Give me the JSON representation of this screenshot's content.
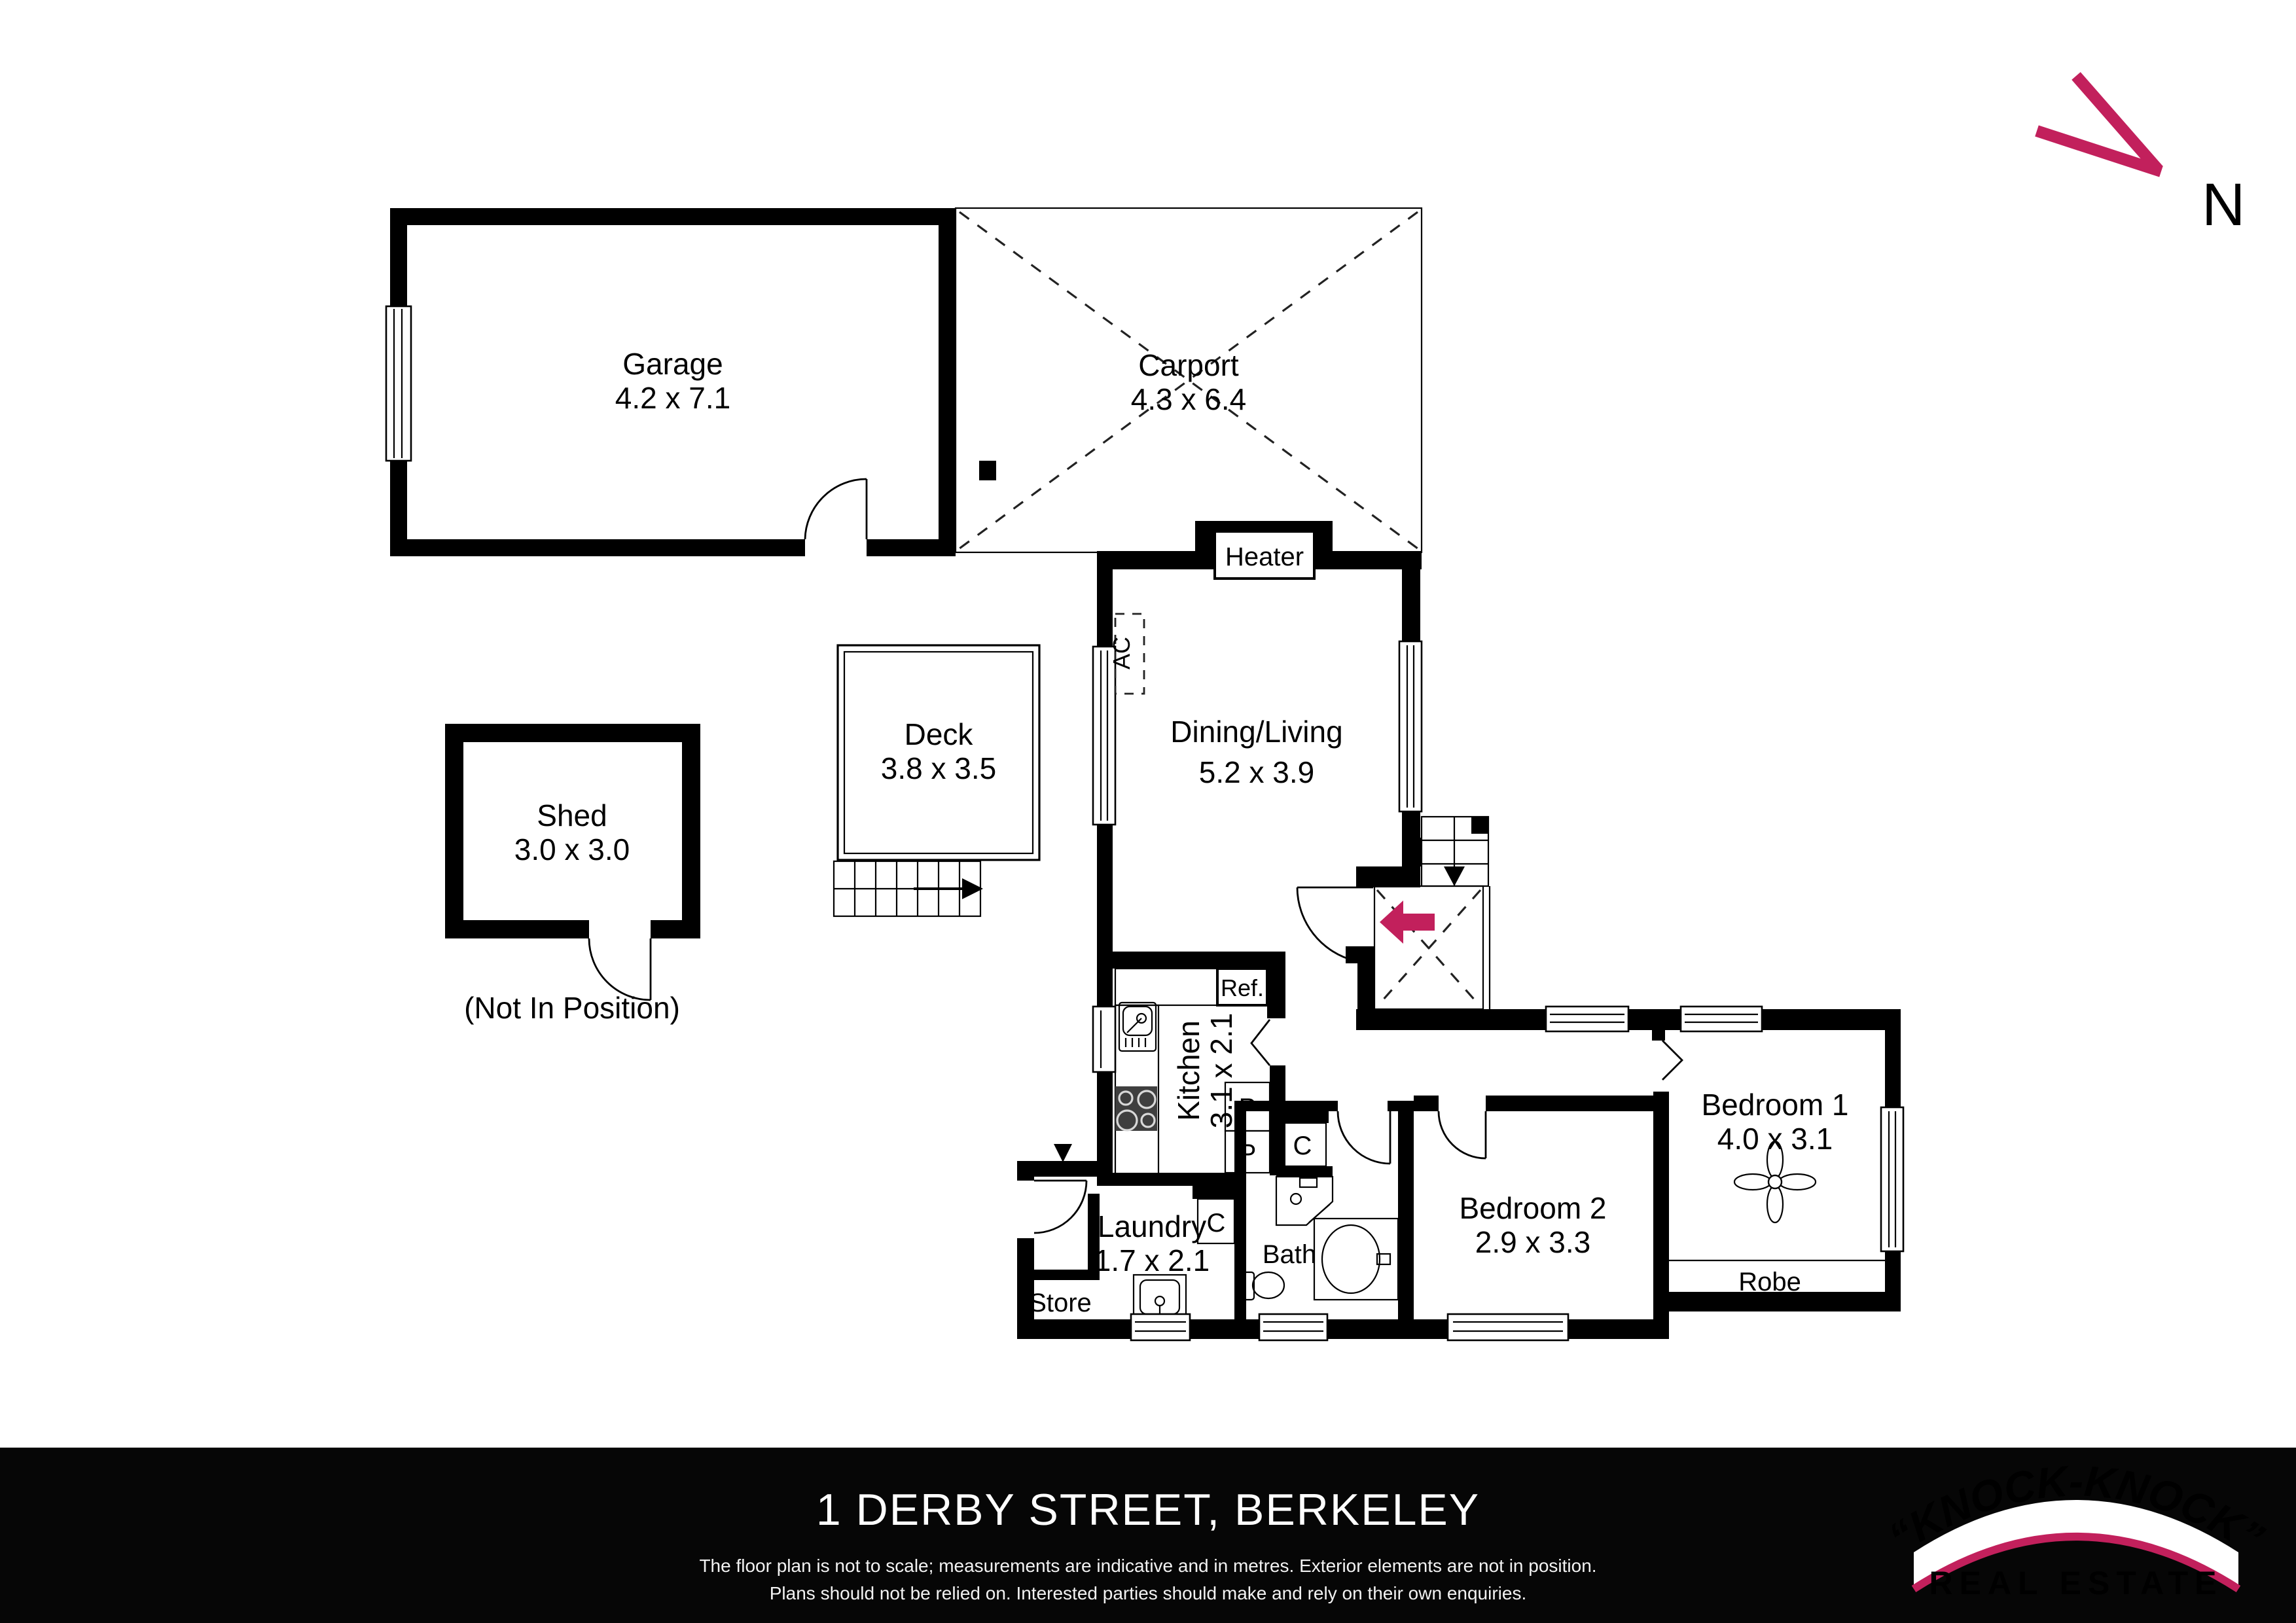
{
  "north": {
    "label": "N"
  },
  "colors": {
    "accent": "#c2205c",
    "wall": "#000000",
    "footer_bg": "#060606",
    "stove": "#3f3f3f"
  },
  "rooms": {
    "garage": {
      "name": "Garage",
      "dims": "4.2 x 7.1"
    },
    "carport": {
      "name": "Carport",
      "dims": "4.3 x 6.4"
    },
    "shed": {
      "name": "Shed",
      "dims": "3.0 x 3.0",
      "note": "(Not In Position)"
    },
    "deck": {
      "name": "Deck",
      "dims": "3.8 x 3.5"
    },
    "dining_living": {
      "name": "Dining/Living",
      "dims": "5.2 x 3.9"
    },
    "kitchen": {
      "name": "Kitchen",
      "dims": "3.1 x 2.1"
    },
    "laundry": {
      "name": "Laundry",
      "dims": "1.7 x 2.1"
    },
    "bath": {
      "name": "Bath"
    },
    "store": {
      "name": "Store"
    },
    "robe": {
      "name": "Robe"
    },
    "bedroom1": {
      "name": "Bedroom 1",
      "dims": "4.0 x 3.1"
    },
    "bedroom2": {
      "name": "Bedroom 2",
      "dims": "2.9 x 3.3"
    }
  },
  "fixtures": {
    "heater": "Heater",
    "ac": "AC",
    "fridge": "Ref.",
    "pantry": "P",
    "cupboard": "C"
  },
  "footer": {
    "address": "1 DERBY STREET, BERKELEY",
    "disclaimer_line1": "The floor plan is not to scale; measurements are indicative and in metres. Exterior elements are not in position.",
    "disclaimer_line2": "Plans should not be relied on. Interested parties should make and rely on their own enquiries.",
    "logo": {
      "brand": "“KNOCK-KNOCK”",
      "tagline": "REAL ESTATE"
    }
  }
}
